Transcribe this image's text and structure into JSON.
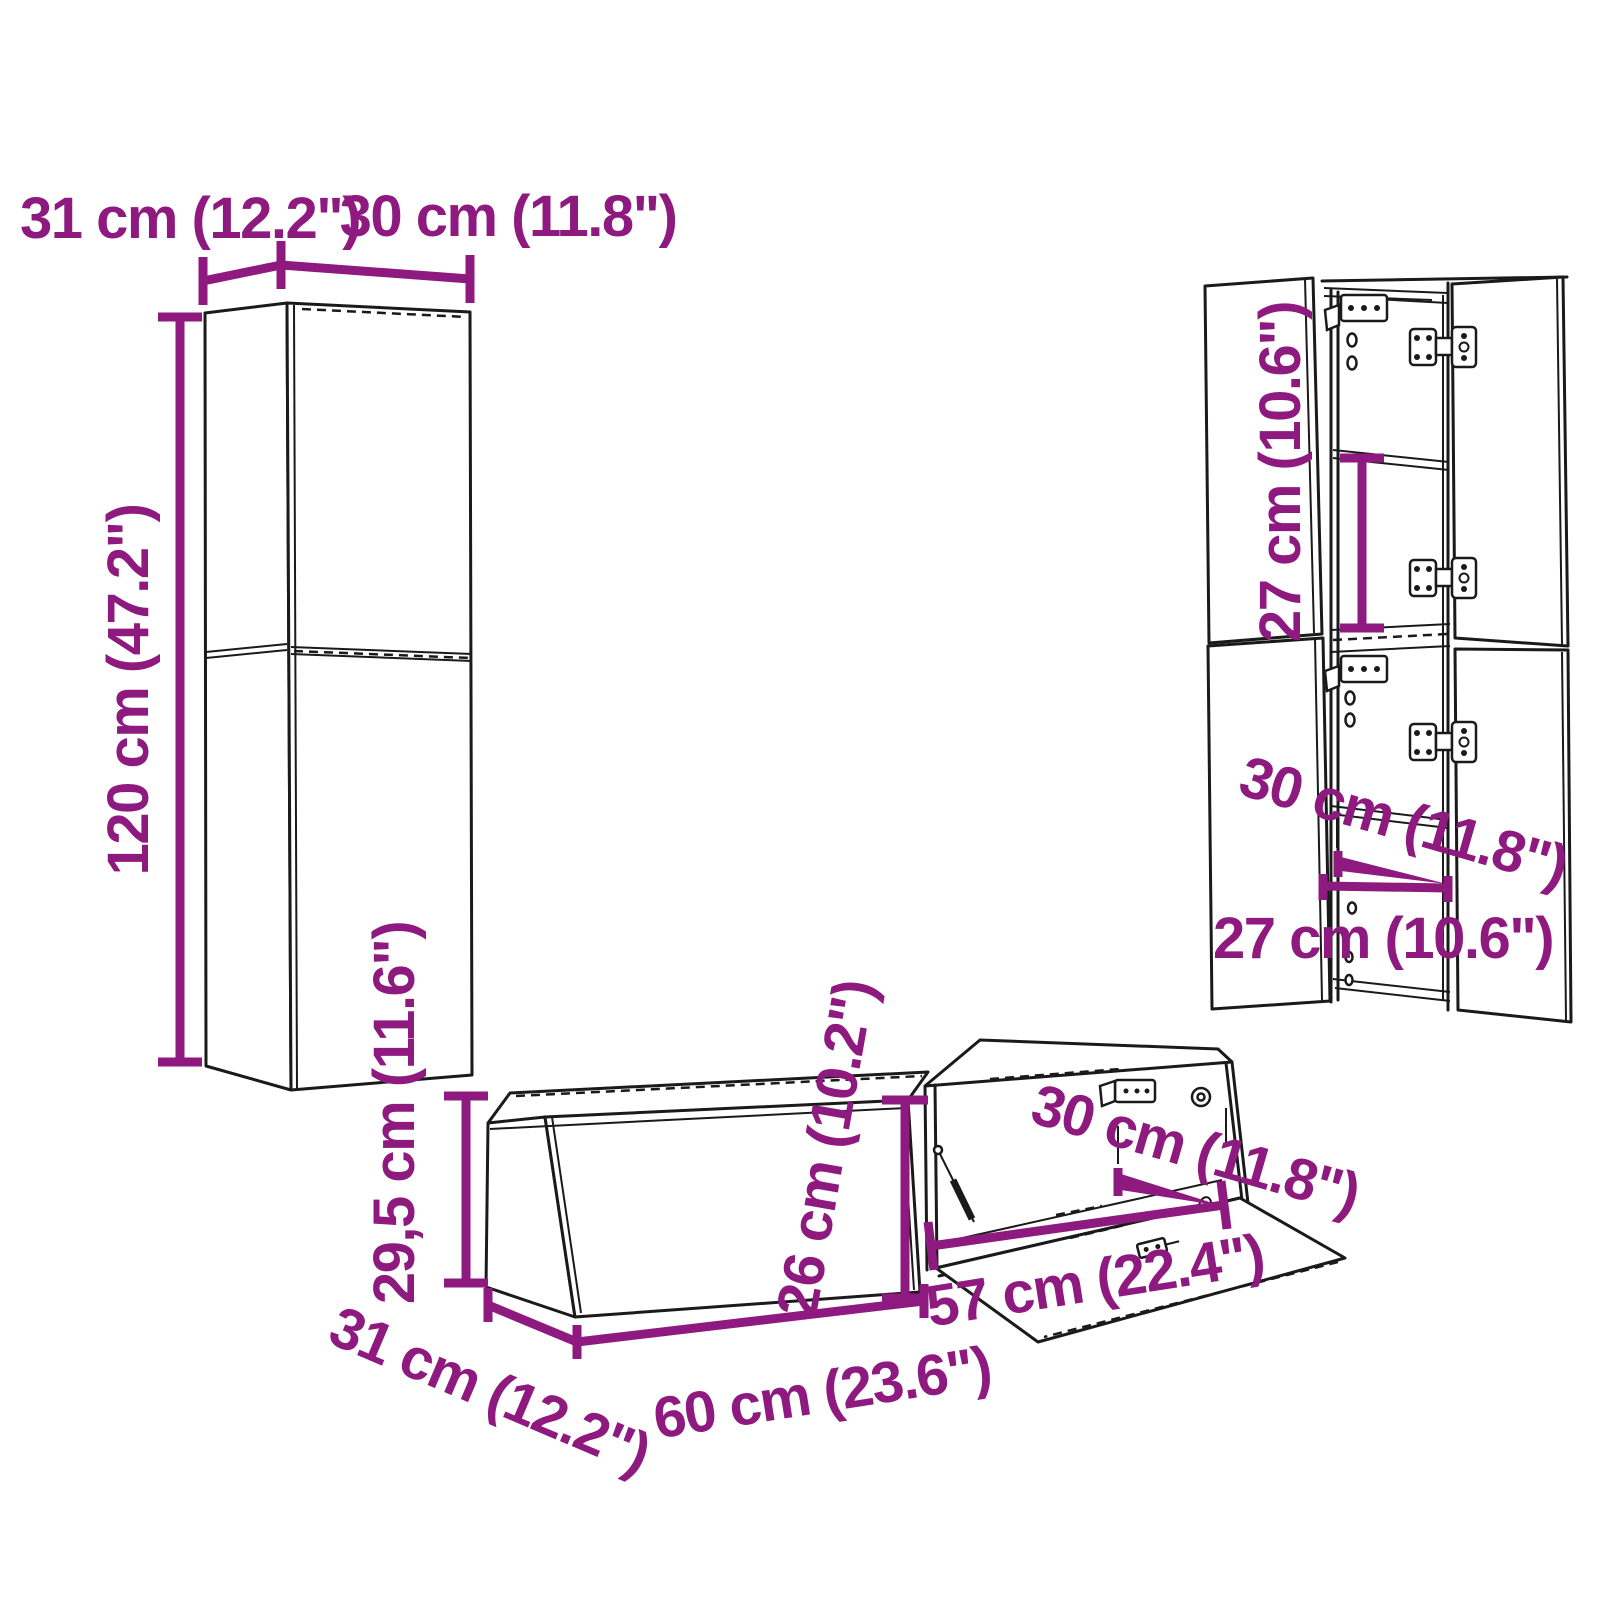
{
  "diagram": {
    "type": "furniture-dimension-diagram",
    "background": "#ffffff",
    "accent_color": "#8E1A7F",
    "line_color": "#1a1a1a"
  },
  "wall_unit_set": {
    "tall_cabinet_closed": {
      "depth_label": "31 cm (12.2\")",
      "width_label": "30 cm (11.8\")",
      "height_label": "120 cm (47.2\")"
    },
    "tall_cabinet_open": {
      "compartment_height_label": "27 cm (10.6\")",
      "inner_depth_label": "30 cm (11.8\")",
      "inner_width_label": "27 cm (10.6\")"
    },
    "tv_cabinet_closed": {
      "height_label": "29,5 cm (11.6\")",
      "depth_label": "31 cm (12.2\")",
      "width_label": "60 cm (23.6\")"
    },
    "tv_cabinet_open_flap": {
      "inner_height_label": "26 cm (10.2\")",
      "inner_depth_label": "30 cm (11.8\")",
      "flap_width_label": "57 cm (22.4\")"
    }
  }
}
